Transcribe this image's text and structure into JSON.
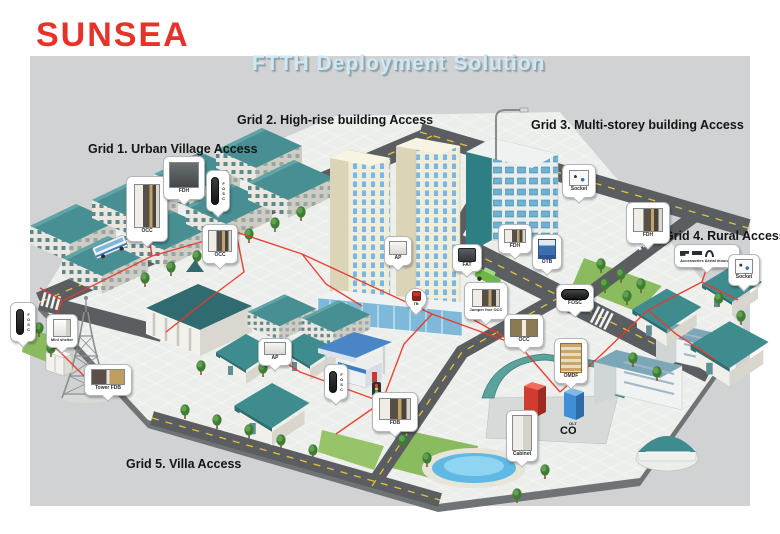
{
  "logo": {
    "text": "SUNSEA"
  },
  "title": "FTTH Deployment Solution",
  "grids": [
    {
      "label": "Grid 1. Urban Village Access"
    },
    {
      "label": "Grid 2. High-rise building Access"
    },
    {
      "label": "Grid 3. Multi-storey building Access"
    },
    {
      "label": "Grid 4. Rural Access"
    },
    {
      "label": "Grid 5. Villa Access"
    }
  ],
  "callouts": [
    {
      "id": "occ-village",
      "label": "OCC"
    },
    {
      "id": "fdh-village",
      "label": "FDH"
    },
    {
      "id": "fosc-pole-village",
      "label": "FOSC"
    },
    {
      "id": "occ-street",
      "label": "OCC"
    },
    {
      "id": "ap-highrise",
      "label": "AP"
    },
    {
      "id": "tb-highrise",
      "label": "TB"
    },
    {
      "id": "fat-highrise",
      "label": "FAT"
    },
    {
      "id": "jumper-free-occ",
      "label": "Jumper free OCC"
    },
    {
      "id": "fdh-street",
      "label": "FDH"
    },
    {
      "id": "otb-street",
      "label": "OTB"
    },
    {
      "id": "fosc-road",
      "label": "FOSC"
    },
    {
      "id": "occ-co",
      "label": "OCC"
    },
    {
      "id": "socket-multistorey",
      "label": "Socket"
    },
    {
      "id": "fdh-rural",
      "label": "FDH"
    },
    {
      "id": "accessories-aerial",
      "label": "Accessories Aerial mounted"
    },
    {
      "id": "socket-rural",
      "label": "Socket"
    },
    {
      "id": "fosc-pole-left",
      "label": "FOSC"
    },
    {
      "id": "mini-shelter",
      "label": "Mini shelter"
    },
    {
      "id": "tower-fdb",
      "label": "Tower FDB"
    },
    {
      "id": "ap-villa",
      "label": "AP"
    },
    {
      "id": "fosc-pole-villa",
      "label": "FOSC"
    },
    {
      "id": "fdb-villa",
      "label": "FDB"
    },
    {
      "id": "omdf-co",
      "label": "OMDF"
    },
    {
      "id": "cabinet-co",
      "label": "Cabinet"
    }
  ],
  "site_labels": {
    "omdf": "OMDF",
    "olt": "OLT",
    "co": "CO"
  },
  "colors": {
    "brand_red": "#e63229",
    "title_blue": "#cde9f3",
    "fiber_red": "#e8392b",
    "roof_teal": "#478f92",
    "road_gray": "#5a5e61",
    "canvas_gray": "#d1d2d3"
  }
}
